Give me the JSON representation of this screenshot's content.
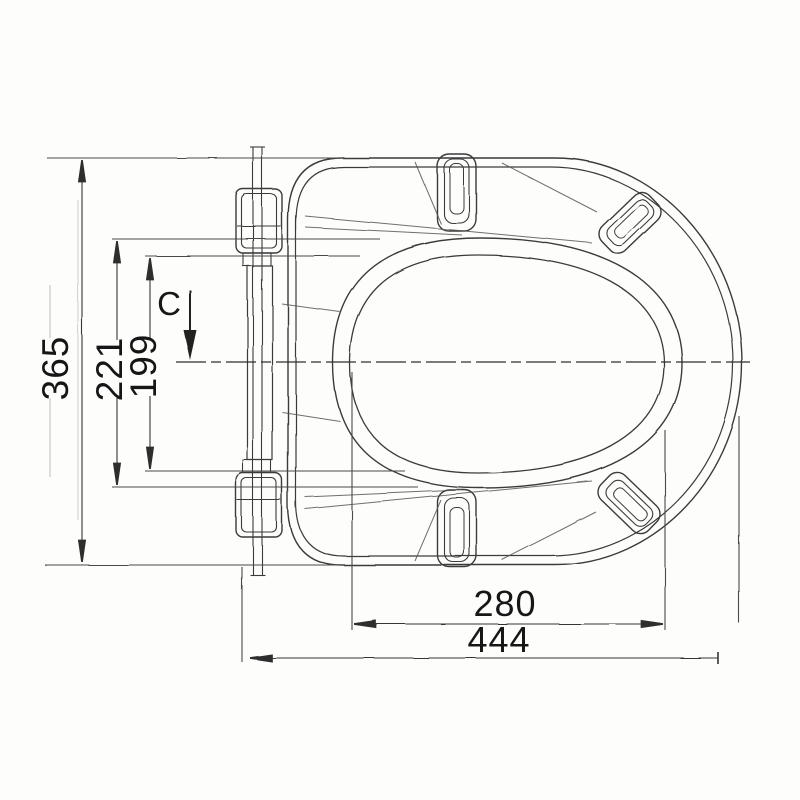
{
  "page": {
    "title": "Toilet seat technical dimension drawing",
    "background": "#fdfdfc"
  },
  "drawing": {
    "view": "top view of toilet seat with hinge, seat ring, bumpers and dimension lines",
    "dimensions": {
      "overall_height": "365",
      "seat_ring_height": "221",
      "opening_height": "199",
      "opening_width": "280",
      "overall_width": "444"
    },
    "labels": {
      "centerline_mark": "C"
    },
    "colors": {
      "line": "#3b3b3b",
      "dim_line": "#4a4a4a",
      "text": "#161616",
      "background": "#fdfdfc"
    }
  }
}
